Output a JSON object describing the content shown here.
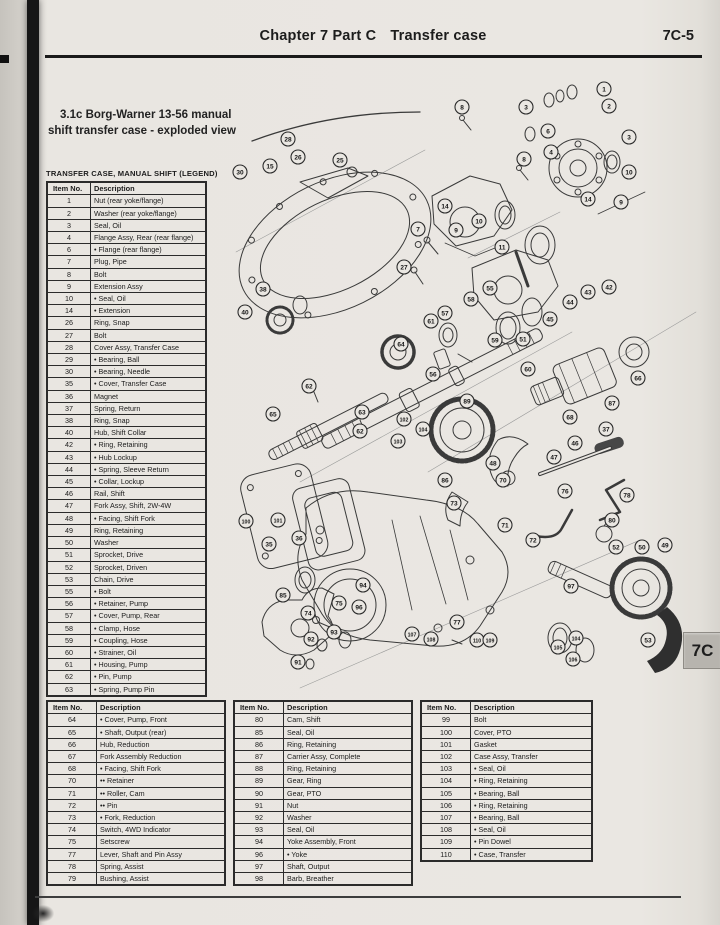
{
  "header": {
    "chapter": "Chapter 7  Part C",
    "section": "Transfer case",
    "page_number": "7C-5",
    "side_tab": "7C"
  },
  "figure": {
    "caption_line1": "3.1c  Borg-Warner 13-56 manual",
    "caption_line2": "shift transfer case - exploded view",
    "legend_title": "TRANSFER CASE, MANUAL SHIFT (LEGEND)",
    "legend": {
      "columns": [
        "Item No.",
        "Description"
      ],
      "rows": [
        [
          "1",
          "Nut (rear yoke/flange)"
        ],
        [
          "2",
          "Washer (rear yoke/flange)"
        ],
        [
          "3",
          "Seal, Oil"
        ],
        [
          "4",
          "Flange Assy, Rear (rear flange)"
        ],
        [
          "6",
          "• Flange (rear flange)"
        ],
        [
          "7",
          "Plug, Pipe"
        ],
        [
          "8",
          "Bolt"
        ],
        [
          "9",
          "Extension Assy"
        ],
        [
          "10",
          "• Seal, Oil"
        ],
        [
          "14",
          "• Extension"
        ],
        [
          "26",
          "Ring, Snap"
        ],
        [
          "27",
          "Bolt"
        ],
        [
          "28",
          "Cover Assy, Transfer Case"
        ],
        [
          "29",
          "• Bearing, Ball"
        ],
        [
          "30",
          "• Bearing, Needle"
        ],
        [
          "35",
          "• Cover, Transfer Case"
        ],
        [
          "36",
          "Magnet"
        ],
        [
          "37",
          "Spring, Return"
        ],
        [
          "38",
          "Ring, Snap"
        ],
        [
          "40",
          "Hub, Shift Collar"
        ],
        [
          "42",
          "• Ring, Retaining"
        ],
        [
          "43",
          "• Hub Lockup"
        ],
        [
          "44",
          "• Spring, Sleeve Return"
        ],
        [
          "45",
          "• Collar, Lockup"
        ],
        [
          "46",
          "Rail, Shift"
        ],
        [
          "47",
          "Fork Assy, Shift, 2W-4W"
        ],
        [
          "48",
          "• Facing, Shift Fork"
        ],
        [
          "49",
          "Ring, Retaining"
        ],
        [
          "50",
          "Washer"
        ],
        [
          "51",
          "Sprocket, Drive"
        ],
        [
          "52",
          "Sprocket, Driven"
        ],
        [
          "53",
          "Chain, Drive"
        ],
        [
          "55",
          "• Bolt"
        ],
        [
          "56",
          "• Retainer, Pump"
        ],
        [
          "57",
          "• Cover, Pump, Rear"
        ],
        [
          "58",
          "• Clamp, Hose"
        ],
        [
          "59",
          "• Coupling, Hose"
        ],
        [
          "60",
          "• Strainer, Oil"
        ],
        [
          "61",
          "• Housing, Pump"
        ],
        [
          "62",
          "• Pin, Pump"
        ],
        [
          "63",
          "• Spring, Pump Pin"
        ]
      ]
    },
    "table2": {
      "columns": [
        "Item No.",
        "Description"
      ],
      "rows": [
        [
          "64",
          "• Cover, Pump, Front"
        ],
        [
          "65",
          "• Shaft, Output (rear)"
        ],
        [
          "66",
          "Hub, Reduction"
        ],
        [
          "67",
          "Fork Assembly Reduction"
        ],
        [
          "68",
          "• Facing, Shift Fork"
        ],
        [
          "70",
          "•• Retainer"
        ],
        [
          "71",
          "•• Roller, Cam"
        ],
        [
          "72",
          "•• Pin"
        ],
        [
          "73",
          "• Fork, Reduction"
        ],
        [
          "74",
          "Switch, 4WD Indicator"
        ],
        [
          "75",
          "Setscrew"
        ],
        [
          "77",
          "Lever, Shaft and Pin Assy"
        ],
        [
          "78",
          "Spring, Assist"
        ],
        [
          "79",
          "Bushing, Assist"
        ]
      ]
    },
    "table3": {
      "columns": [
        "Item No.",
        "Description"
      ],
      "rows": [
        [
          "80",
          "Cam, Shift"
        ],
        [
          "85",
          "Seal, Oil"
        ],
        [
          "86",
          "Ring, Retaining"
        ],
        [
          "87",
          "Carrier Assy, Complete"
        ],
        [
          "88",
          "Ring, Retaining"
        ],
        [
          "89",
          "Gear, Ring"
        ],
        [
          "90",
          "Gear, PTO"
        ],
        [
          "91",
          "Nut"
        ],
        [
          "92",
          "Washer"
        ],
        [
          "93",
          "Seal, Oil"
        ],
        [
          "94",
          "Yoke Assembly, Front"
        ],
        [
          "96",
          "• Yoke"
        ],
        [
          "97",
          "Shaft, Output"
        ],
        [
          "98",
          "Barb, Breather"
        ]
      ]
    },
    "table4": {
      "columns": [
        "Item No.",
        "Description"
      ],
      "rows": [
        [
          "99",
          "Bolt"
        ],
        [
          "100",
          "Cover, PTO"
        ],
        [
          "101",
          "Gasket"
        ],
        [
          "102",
          "Case Assy, Transfer"
        ],
        [
          "103",
          "• Seal, Oil"
        ],
        [
          "104",
          "• Ring, Retaining"
        ],
        [
          "105",
          "• Bearing, Ball"
        ],
        [
          "106",
          "• Ring, Retaining"
        ],
        [
          "107",
          "• Bearing, Ball"
        ],
        [
          "108",
          "• Seal, Oil"
        ],
        [
          "109",
          "• Pin Dowel"
        ],
        [
          "110",
          "• Case, Transfer"
        ]
      ]
    },
    "callouts": [
      {
        "n": "1",
        "x": 604,
        "y": 89
      },
      {
        "n": "2",
        "x": 609,
        "y": 106
      },
      {
        "n": "3",
        "x": 526,
        "y": 107
      },
      {
        "n": "8",
        "x": 462,
        "y": 107
      },
      {
        "n": "6",
        "x": 548,
        "y": 131
      },
      {
        "n": "3",
        "x": 629,
        "y": 137
      },
      {
        "n": "4",
        "x": 551,
        "y": 152
      },
      {
        "n": "8",
        "x": 524,
        "y": 159
      },
      {
        "n": "10",
        "x": 629,
        "y": 172
      },
      {
        "n": "14",
        "x": 588,
        "y": 199
      },
      {
        "n": "9",
        "x": 621,
        "y": 202
      },
      {
        "n": "14",
        "x": 445,
        "y": 206
      },
      {
        "n": "10",
        "x": 479,
        "y": 221
      },
      {
        "n": "9",
        "x": 456,
        "y": 230
      },
      {
        "n": "28",
        "x": 288,
        "y": 139
      },
      {
        "n": "26",
        "x": 298,
        "y": 157
      },
      {
        "n": "25",
        "x": 340,
        "y": 160
      },
      {
        "n": "15",
        "x": 270,
        "y": 166
      },
      {
        "n": "30",
        "x": 240,
        "y": 172
      },
      {
        "n": "7",
        "x": 418,
        "y": 229
      },
      {
        "n": "11",
        "x": 502,
        "y": 247
      },
      {
        "n": "27",
        "x": 404,
        "y": 267
      },
      {
        "n": "42",
        "x": 609,
        "y": 287
      },
      {
        "n": "43",
        "x": 588,
        "y": 292
      },
      {
        "n": "44",
        "x": 570,
        "y": 302
      },
      {
        "n": "45",
        "x": 550,
        "y": 319
      },
      {
        "n": "55",
        "x": 490,
        "y": 288
      },
      {
        "n": "58",
        "x": 471,
        "y": 299
      },
      {
        "n": "57",
        "x": 445,
        "y": 313
      },
      {
        "n": "61",
        "x": 431,
        "y": 321
      },
      {
        "n": "38",
        "x": 263,
        "y": 289
      },
      {
        "n": "40",
        "x": 245,
        "y": 312
      },
      {
        "n": "51",
        "x": 523,
        "y": 339
      },
      {
        "n": "59",
        "x": 495,
        "y": 340
      },
      {
        "n": "60",
        "x": 528,
        "y": 369
      },
      {
        "n": "56",
        "x": 433,
        "y": 374
      },
      {
        "n": "64",
        "x": 401,
        "y": 344
      },
      {
        "n": "66",
        "x": 638,
        "y": 378
      },
      {
        "n": "87",
        "x": 612,
        "y": 403
      },
      {
        "n": "68",
        "x": 570,
        "y": 417
      },
      {
        "n": "37",
        "x": 606,
        "y": 429
      },
      {
        "n": "62",
        "x": 309,
        "y": 386
      },
      {
        "n": "65",
        "x": 273,
        "y": 414
      },
      {
        "n": "63",
        "x": 362,
        "y": 412
      },
      {
        "n": "62",
        "x": 360,
        "y": 431
      },
      {
        "n": "89",
        "x": 467,
        "y": 401
      },
      {
        "n": "102",
        "x": 404,
        "y": 419
      },
      {
        "n": "104",
        "x": 423,
        "y": 429
      },
      {
        "n": "103",
        "x": 398,
        "y": 441
      },
      {
        "n": "86",
        "x": 445,
        "y": 480
      },
      {
        "n": "46",
        "x": 575,
        "y": 443
      },
      {
        "n": "47",
        "x": 554,
        "y": 457
      },
      {
        "n": "48",
        "x": 493,
        "y": 463
      },
      {
        "n": "70",
        "x": 503,
        "y": 480
      },
      {
        "n": "76",
        "x": 565,
        "y": 491
      },
      {
        "n": "78",
        "x": 627,
        "y": 495
      },
      {
        "n": "71",
        "x": 505,
        "y": 525
      },
      {
        "n": "72",
        "x": 533,
        "y": 540
      },
      {
        "n": "73",
        "x": 454,
        "y": 503
      },
      {
        "n": "80",
        "x": 612,
        "y": 520
      },
      {
        "n": "52",
        "x": 616,
        "y": 547
      },
      {
        "n": "50",
        "x": 642,
        "y": 547
      },
      {
        "n": "49",
        "x": 665,
        "y": 545
      },
      {
        "n": "97",
        "x": 571,
        "y": 586
      },
      {
        "n": "100",
        "x": 246,
        "y": 521
      },
      {
        "n": "101",
        "x": 278,
        "y": 520
      },
      {
        "n": "36",
        "x": 299,
        "y": 538
      },
      {
        "n": "35",
        "x": 269,
        "y": 544
      },
      {
        "n": "85",
        "x": 283,
        "y": 595
      },
      {
        "n": "75",
        "x": 339,
        "y": 603
      },
      {
        "n": "74",
        "x": 308,
        "y": 613
      },
      {
        "n": "94",
        "x": 363,
        "y": 585
      },
      {
        "n": "96",
        "x": 359,
        "y": 607
      },
      {
        "n": "93",
        "x": 334,
        "y": 632
      },
      {
        "n": "92",
        "x": 311,
        "y": 639
      },
      {
        "n": "91",
        "x": 298,
        "y": 662
      },
      {
        "n": "107",
        "x": 412,
        "y": 634
      },
      {
        "n": "108",
        "x": 431,
        "y": 639
      },
      {
        "n": "77",
        "x": 457,
        "y": 622
      },
      {
        "n": "110",
        "x": 477,
        "y": 640
      },
      {
        "n": "109",
        "x": 490,
        "y": 640
      },
      {
        "n": "105",
        "x": 558,
        "y": 647
      },
      {
        "n": "104",
        "x": 576,
        "y": 638
      },
      {
        "n": "106",
        "x": 573,
        "y": 659
      },
      {
        "n": "53",
        "x": 648,
        "y": 640
      }
    ]
  }
}
